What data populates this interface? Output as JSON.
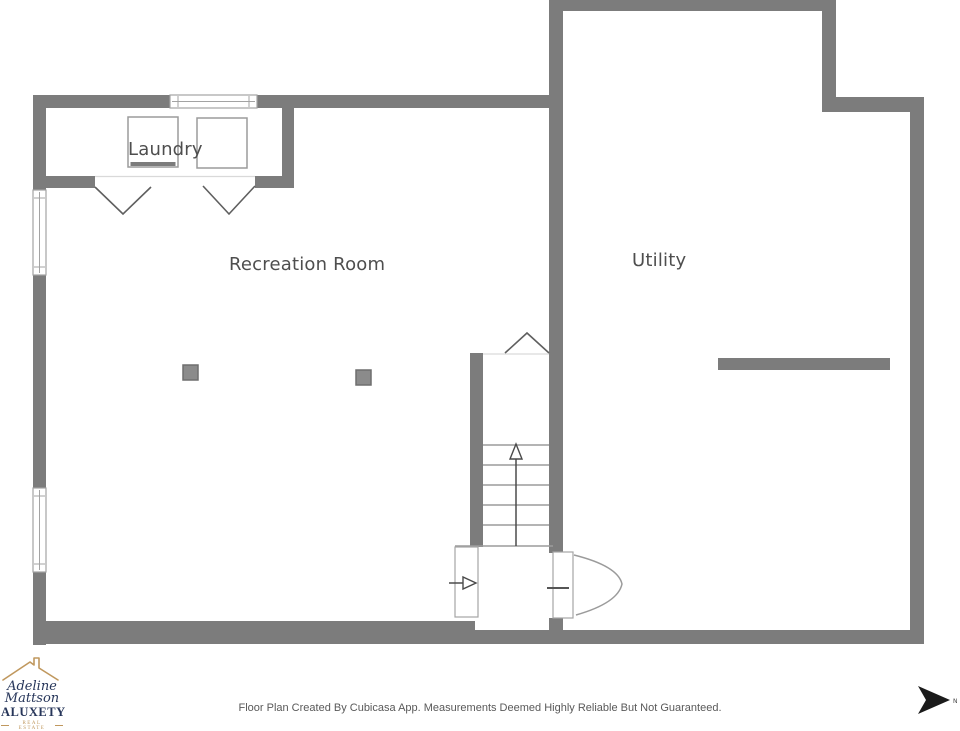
{
  "colors": {
    "wall": "#7c7c7c",
    "frame": "#a3a3a3",
    "stairline": "#9b9b9b",
    "doorline": "#5f5f5f",
    "text": "#4e4e4e",
    "footertext": "#595959",
    "navy": "#27365a",
    "gold": "#c0985e",
    "north": "#1b1b1b",
    "postfill": "#8b8b8b",
    "postedge": "#6e6e6e"
  },
  "rooms": {
    "laundry": "Laundry",
    "recreation": "Recreation Room",
    "utility": "Utility"
  },
  "footer": {
    "disclaimer": "Floor Plan Created By Cubicasa App. Measurements Deemed Highly Reliable But Not Guaranteed.",
    "north_label": "N"
  },
  "logo": {
    "name_line1": "Adeline",
    "name_line2": "Mattson",
    "brand": "ALUXETY",
    "tagline": "REAL ESTATE"
  }
}
